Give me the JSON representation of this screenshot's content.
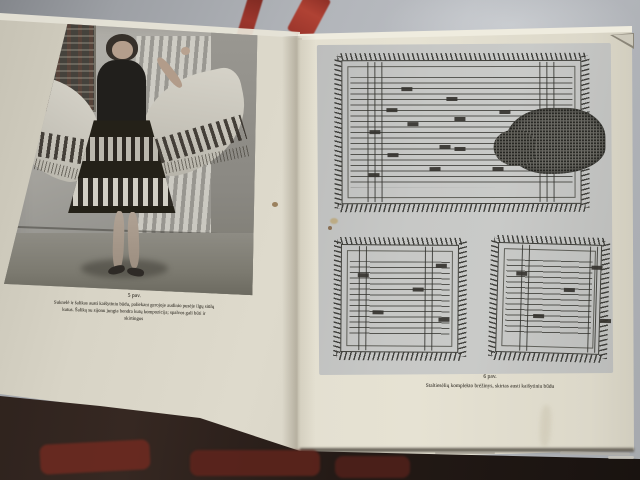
{
  "book": {
    "left_page": {
      "figure_label": "5 pav.",
      "caption_lines": [
        "Suknelė ir šalikas austi kaišytiniu būdu, paliekant gerojoje audinio pusėje ilgų siūlų",
        "kutus. Šaliką su sijonu jungia bendra kutų kompozicija; spalvos gali būti ir",
        "skirtingos"
      ]
    },
    "right_page": {
      "figure_label": "6 pav.",
      "caption": "Staltiesėlių komplekto brėžinys, skirtas austi kaišytiniu būdu"
    }
  },
  "figures": {
    "type": "weaving-pattern-diagrams",
    "large_tablecloth": {
      "motifs": [
        [
          68,
          35
        ],
        [
          113,
          45
        ],
        [
          53,
          56
        ],
        [
          121,
          65
        ],
        [
          74,
          70
        ],
        [
          36,
          78
        ],
        [
          166,
          58
        ],
        [
          106,
          93
        ],
        [
          121,
          95
        ],
        [
          54,
          101
        ],
        [
          96,
          115
        ],
        [
          159,
          115
        ],
        [
          35,
          121
        ]
      ]
    },
    "small_left": {
      "motifs": [
        [
          25,
          37
        ],
        [
          80,
          51
        ],
        [
          103,
          27
        ],
        [
          40,
          74
        ],
        [
          106,
          81
        ]
      ]
    },
    "small_right": {
      "motifs": [
        [
          27,
          37
        ],
        [
          102,
          29
        ],
        [
          75,
          52
        ],
        [
          45,
          79
        ],
        [
          112,
          82
        ]
      ]
    }
  },
  "colors": {
    "stripe_red": "#9c362c",
    "page_left": "#d8d4c6",
    "page_right": "#e2decf",
    "plate_grey": "#c7c8c6",
    "table_dark": "#362822",
    "table_red": "#6e2a20"
  }
}
